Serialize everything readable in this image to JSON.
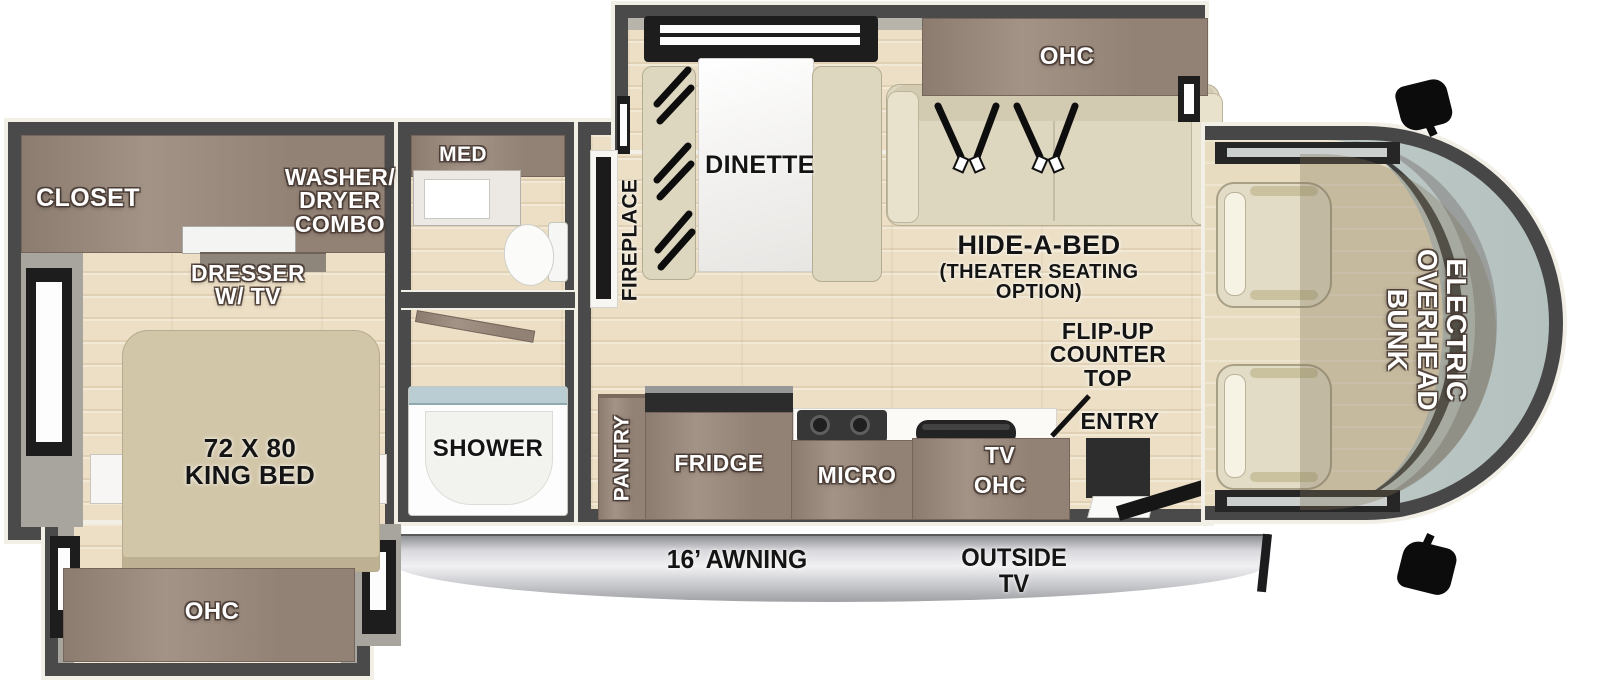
{
  "floorplan": {
    "bedroom": {
      "closet_label": "CLOSET",
      "washer_dryer_label": "WASHER/\nDRYER\nCOMBO",
      "dresser_label": "DRESSER\nW/ TV",
      "king_bed_label": "72 X 80\nKING BED",
      "overhead_cabinet_label": "OHC"
    },
    "bathroom": {
      "medicine_cabinet_label": "MED",
      "shower_label": "SHOWER"
    },
    "living_area": {
      "fireplace_label": "FIREPLACE",
      "dinette_label": "DINETTE",
      "overhead_cabinet_label": "OHC",
      "hide_a_bed_label": "HIDE-A-BED",
      "hide_a_bed_sub_label": "(THEATER SEATING\nOPTION)",
      "flip_up_counter_label": "FLIP-UP\nCOUNTER\nTOP",
      "entry_label": "ENTRY"
    },
    "kitchen": {
      "pantry_label": "PANTRY",
      "fridge_label": "FRIDGE",
      "microwave_label": "MICRO",
      "tv_ohc_label": "TV\nOHC"
    },
    "cab": {
      "overhead_bunk_label": "ELECTRIC\nOVERHEAD\nBUNK"
    },
    "exterior": {
      "awning_label": "16’ AWNING",
      "outside_tv_label": "OUTSIDE\nTV"
    },
    "colors": {
      "wall": "#4a4a4a",
      "trim": "#f2efe6",
      "wood_floor": "#ecdfc5",
      "cabinet_wood": "#9b8a7c",
      "upholstery": "#ded7bf",
      "windshield_glass": "#b9c5c2",
      "awning_silver": "#d8d8dc",
      "label_white": "#ffffff",
      "label_black": "#141414"
    }
  }
}
